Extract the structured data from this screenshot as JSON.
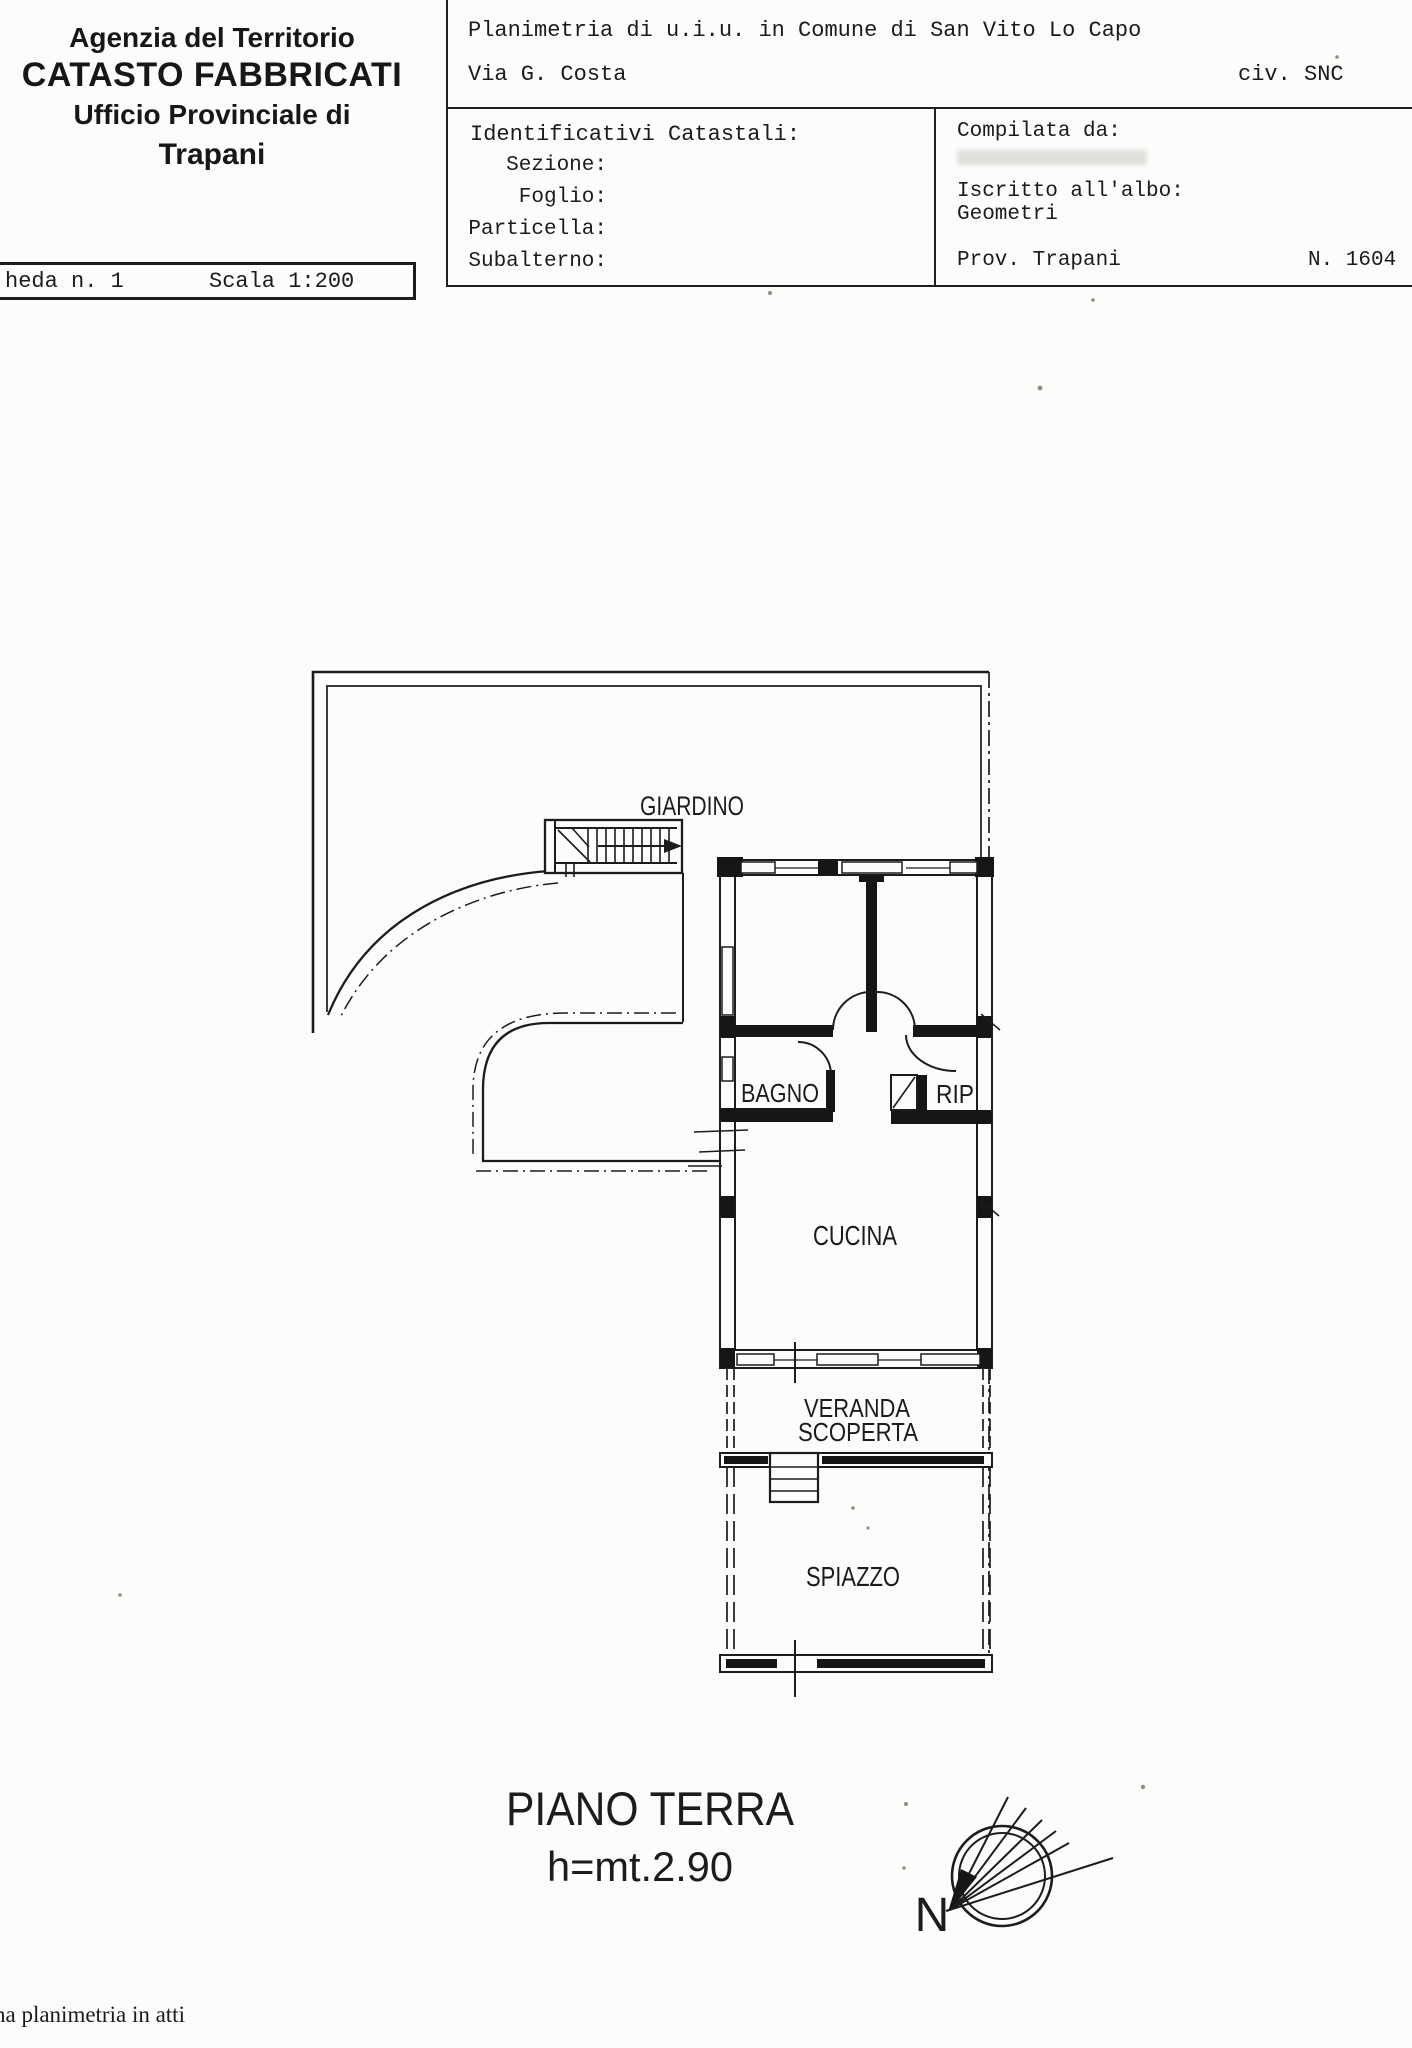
{
  "colors": {
    "paper": "#fcfcfa",
    "ink": "#1c1c1c"
  },
  "header": {
    "agency_line1": "Agenzia del Territorio",
    "agency_line2": "CATASTO FABBRICATI",
    "agency_line3": "Ufficio Provinciale di",
    "agency_line4": "Trapani",
    "planimetria_line": "Planimetria di u.i.u. in Comune di San Vito Lo Capo",
    "street": "Via G. Costa",
    "civic": "civ. SNC",
    "identificativi_title": "Identificativi Catastali:",
    "fields": [
      {
        "label": "Sezione:"
      },
      {
        "label": "Foglio:"
      },
      {
        "label": "Particella:"
      },
      {
        "label": "Subalterno:"
      }
    ],
    "compilata_label": "Compilata da:",
    "albo_label": "Iscritto all'albo:",
    "albo_value": "Geometri",
    "prov_label": "Prov. Trapani",
    "albo_number": "N. 1604",
    "scheda": "heda n. 1",
    "scala": "Scala 1:200"
  },
  "plan": {
    "labels": {
      "garden": "GIARDINO",
      "bath": "BAGNO",
      "storage": "RIP",
      "kitchen": "CUCINA",
      "veranda_line1": "VERANDA",
      "veranda_line2": "SCOPERTA",
      "yard": "SPIAZZO"
    },
    "floor_title": "PIANO TERRA",
    "floor_height": "h=mt.2.90",
    "compass_label": "N"
  },
  "footer": {
    "note": "na planimetria in atti"
  }
}
